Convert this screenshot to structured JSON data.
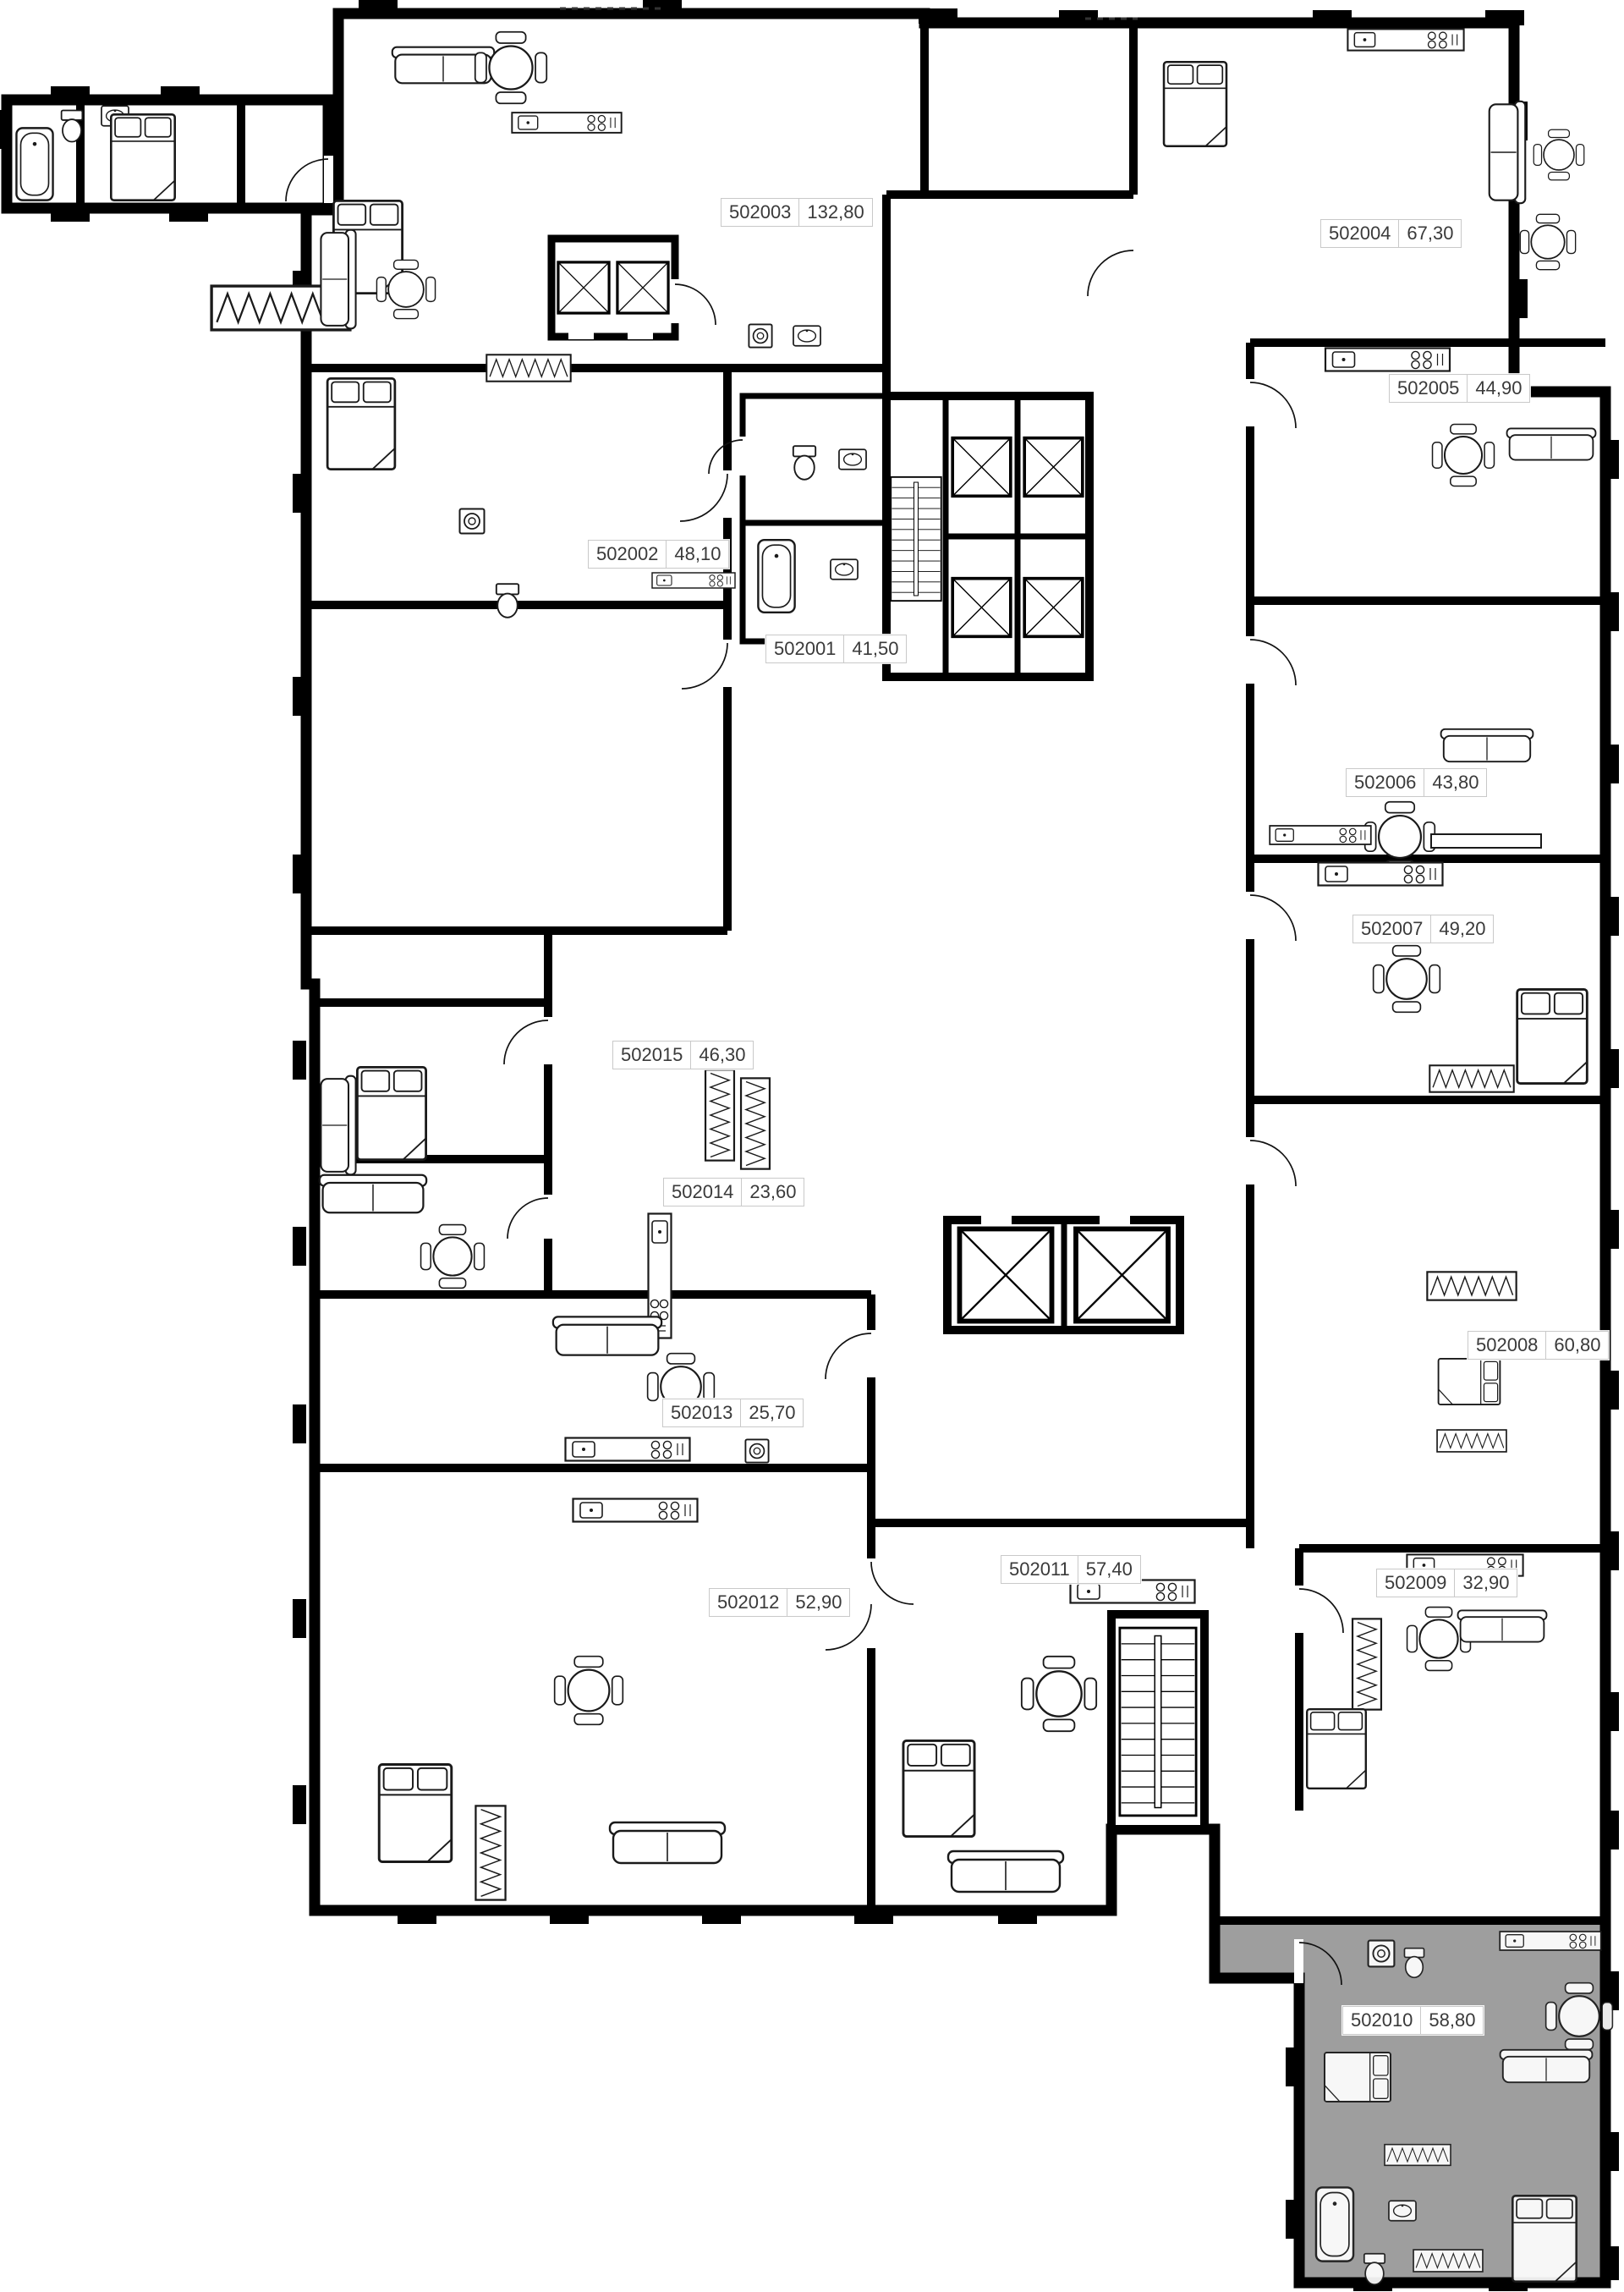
{
  "plan": {
    "highlighted_unit_id": "502010",
    "units": [
      {
        "id": "502003",
        "area": "132,80",
        "highlighted": false
      },
      {
        "id": "502004",
        "area": "67,30",
        "highlighted": false
      },
      {
        "id": "502005",
        "area": "44,90",
        "highlighted": false
      },
      {
        "id": "502002",
        "area": "48,10",
        "highlighted": false
      },
      {
        "id": "502001",
        "area": "41,50",
        "highlighted": false
      },
      {
        "id": "502006",
        "area": "43,80",
        "highlighted": false
      },
      {
        "id": "502007",
        "area": "49,20",
        "highlighted": false
      },
      {
        "id": "502015",
        "area": "46,30",
        "highlighted": false
      },
      {
        "id": "502014",
        "area": "23,60",
        "highlighted": false
      },
      {
        "id": "502008",
        "area": "60,80",
        "highlighted": false
      },
      {
        "id": "502013",
        "area": "25,70",
        "highlighted": false
      },
      {
        "id": "502011",
        "area": "57,40",
        "highlighted": false
      },
      {
        "id": "502012",
        "area": "52,90",
        "highlighted": false
      },
      {
        "id": "502009",
        "area": "32,90",
        "highlighted": false
      },
      {
        "id": "502010",
        "area": "58,80",
        "highlighted": true
      }
    ],
    "colors": {
      "wall": "#000000",
      "background": "#ffffff",
      "highlight": "#9e9e9e",
      "label_border": "#c9c9c9",
      "label_text": "#3a3a3a"
    }
  }
}
